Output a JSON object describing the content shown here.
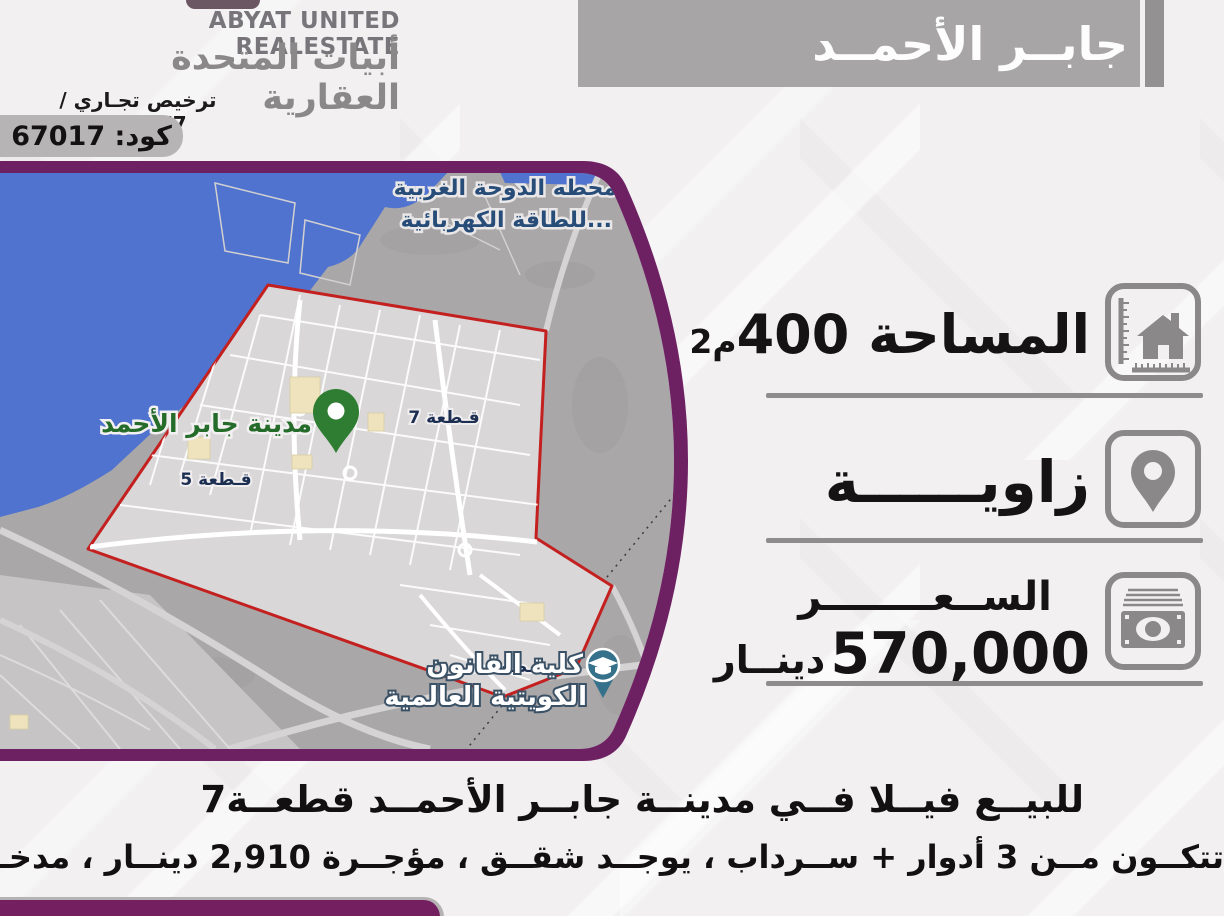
{
  "header": {
    "company_en": "ABYAT UNITED REALESTATE",
    "company_ar": "أبيات المتحدة العقارية",
    "license": "ترخيص تجـاري / 4459977",
    "code": "كود: 67017",
    "banner_title": "جابــر الأحمــد"
  },
  "details": {
    "area": {
      "label": "المساحة",
      "number": "400",
      "unit": "م2"
    },
    "corner": {
      "label": "زاويــــــة"
    },
    "price": {
      "label": "الســعــــــــر",
      "number": "570,000",
      "currency": "دينــار"
    }
  },
  "map": {
    "city_label": "مدينة جابر الأحمد",
    "block7": "قـطعة 7",
    "block5": "قـطعة 5",
    "block1": "قـطعة 1",
    "poi_power_line1": "محطه الدوحة الغربية",
    "poi_power_line2": "للطاقة الكهربائية...",
    "poi_law_line1": "كلية القانون",
    "poi_law_line2": "الكويتية العالمية"
  },
  "description": {
    "line1": "للبيــع فيــلا فــي مدينــة جابــر الأحمــد قطعــة7",
    "line2": "تتكــون مــن 3 أدوار + ســرداب ، يوجــد شقــق ، مؤجــرة 2,910 دينــار ، مدخــل ومخــرج سهــل."
  },
  "colors": {
    "purple": "#6e2162",
    "banner_gray": "#a8a5a6",
    "boundary_red": "#c3201f",
    "water_blue": "#4f73cf",
    "pin_green": "#2e7d32",
    "poi_teal": "#35718a",
    "icon_gray": "#8a8888"
  }
}
